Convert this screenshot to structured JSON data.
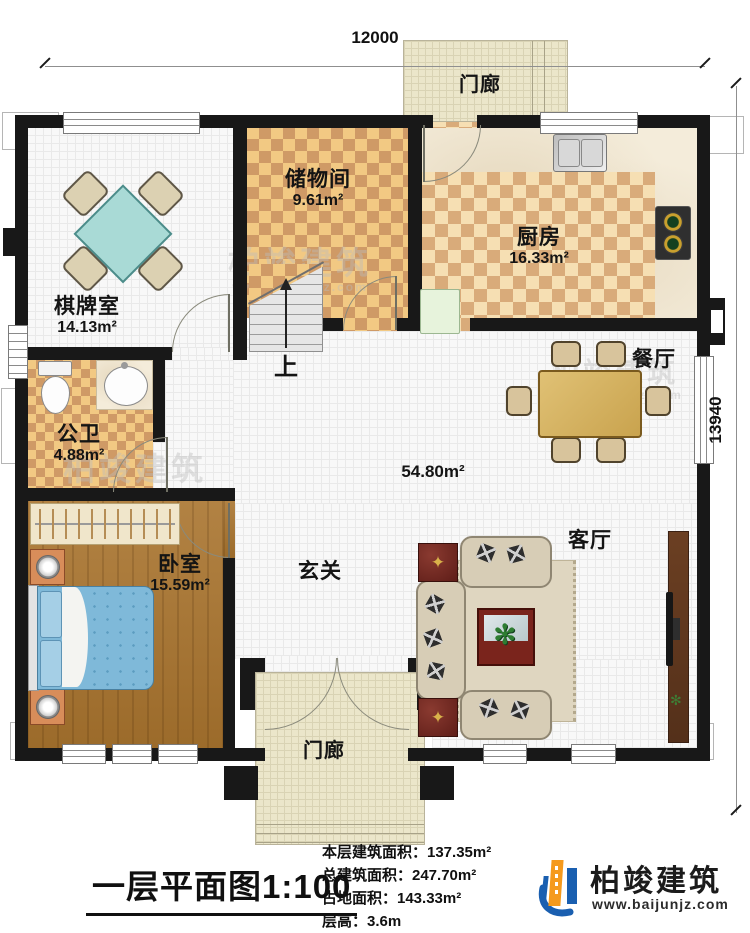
{
  "dimensions": {
    "width_top": "12000",
    "height_right": "13940"
  },
  "rooms": {
    "porch_top": {
      "name": "门廊"
    },
    "chess": {
      "name": "棋牌室",
      "area": "14.13m²"
    },
    "storage": {
      "name": "储物间",
      "area": "9.61m²"
    },
    "kitchen": {
      "name": "厨房",
      "area": "16.33m²"
    },
    "dining": {
      "name": "餐厅"
    },
    "bath": {
      "name": "公卫",
      "area": "4.88m²"
    },
    "hall": {
      "area": "54.80m²"
    },
    "bedroom": {
      "name": "卧室",
      "area": "15.59m²"
    },
    "foyer": {
      "name": "玄关"
    },
    "living": {
      "name": "客厅"
    },
    "porch_bottom": {
      "name": "门廊"
    }
  },
  "stairs": {
    "up_label": "上"
  },
  "icons": {
    "plant": "✻",
    "compass_star": "✦"
  },
  "watermark": {
    "name": "柏竣建筑",
    "url": "www.baijunjz.com"
  },
  "footer": {
    "title": "一层平面图1:100",
    "stats": {
      "floor_area": "本层建筑面积：137.35m²",
      "total_area": "总建筑面积：247.70m²",
      "footprint_area": "占地面积：143.33m²",
      "floor_height": "层高：3.6m"
    },
    "logo": {
      "name": "柏竣建筑",
      "url": "www.baijunjz.com"
    }
  }
}
